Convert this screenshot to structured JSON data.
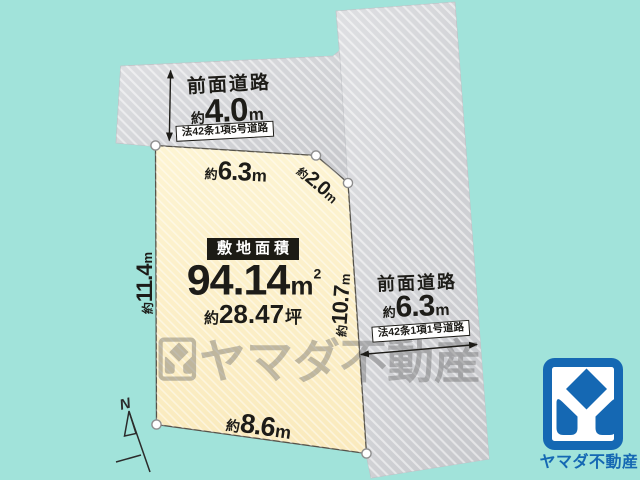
{
  "palette": {
    "background_teal": "#a1e3da",
    "plot_cream": "#fcf1cb",
    "road_silver": "#d2d3d6",
    "outline_dark": "#55524a",
    "text_dark": "#1d1c18",
    "logo_blue": "#1568b3",
    "watermark_gray": "#6f6f6f"
  },
  "compass": {
    "label": "N"
  },
  "top_road": {
    "name": "前面道路",
    "width_prefix": "約",
    "width_value": "4.0",
    "width_unit": "m",
    "law": "法42条1項5号道路"
  },
  "right_road": {
    "name": "前面道路",
    "width_prefix": "約",
    "width_value": "6.3",
    "width_unit": "m",
    "law": "法42条1項1号道路"
  },
  "edges": {
    "top": {
      "prefix": "約",
      "value": "6.3",
      "unit": "m"
    },
    "cut": {
      "prefix": "約",
      "value": "2.0",
      "unit": "m"
    },
    "left": {
      "prefix": "約",
      "value": "11.4",
      "unit": "m"
    },
    "right": {
      "prefix": "約",
      "value": "10.7",
      "unit": "m"
    },
    "bottom": {
      "prefix": "約",
      "value": "8.6",
      "unit": "m"
    }
  },
  "site": {
    "label": "敷地面積",
    "area_value": "94.14",
    "area_unit": "m",
    "area_sup": "2",
    "tsubo_prefix": "約",
    "tsubo_value": "28.47",
    "tsubo_unit": "坪"
  },
  "watermark": {
    "text": "ヤマダ不動産"
  },
  "logo": {
    "text": "ヤマダ不動産"
  }
}
